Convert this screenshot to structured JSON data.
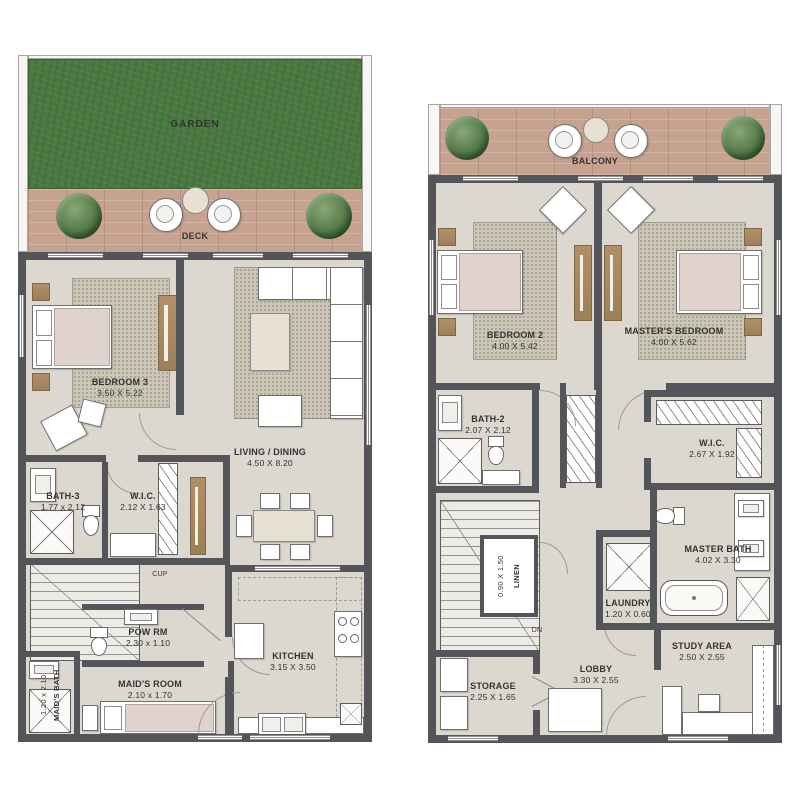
{
  "palette": {
    "wall": "#54555a",
    "floor": "#dcd8d0",
    "garden_green": "#4a7a41",
    "deck_wood": "#c7a290",
    "rug": "#ccc6b7",
    "wood_accent": "#ab8b61",
    "mattress": "#e0d2cd",
    "label_text": "#333333"
  },
  "left_plan": {
    "garden": {
      "label": "GARDEN"
    },
    "deck": {
      "label": "DECK"
    },
    "bedroom3": {
      "name": "BEDROOM 3",
      "dims": "3.50 X 5.22"
    },
    "living_dining": {
      "name": "LIVING / DINING",
      "dims": "4.50 X 8.20"
    },
    "bath3": {
      "name": "BATH-3",
      "dims": "1.77 x 2.12"
    },
    "wic": {
      "name": "W.I.C.",
      "dims": "2.12 X 1.63"
    },
    "cupboard": {
      "label": "CUP"
    },
    "pow_rm": {
      "name": "POW RM",
      "dims": "2.30 x 1.10"
    },
    "maids_room": {
      "name": "MAID'S ROOM",
      "dims": "2.10 x 1.70"
    },
    "maids_bath": {
      "name": "MAID'S BATH",
      "dims": "1.20 x 2.10"
    },
    "kitchen": {
      "name": "KITCHEN",
      "dims": "3.15 X 3.50"
    }
  },
  "right_plan": {
    "balcony": {
      "label": "BALCONY"
    },
    "bedroom2": {
      "name": "BEDROOM 2",
      "dims": "4.00 X 5.42"
    },
    "masters_bedroom": {
      "name": "MASTER'S BEDROOM",
      "dims": "4.00 X 5.62"
    },
    "bath2": {
      "name": "BATH-2",
      "dims": "2.07 X 2.12"
    },
    "wic": {
      "name": "W.I.C.",
      "dims": "2.67 X 1.92"
    },
    "linen": {
      "name": "LINEN",
      "dims": "0.90 X 1.50"
    },
    "laundry": {
      "name": "LAUNDRY",
      "dims": "1.20 X 0.60"
    },
    "master_bath": {
      "name": "MASTER BATH",
      "dims": "4.02 X 3.30"
    },
    "stairs_down": {
      "label": "DN"
    },
    "storage": {
      "name": "STORAGE",
      "dims": "2.25 X 1.65"
    },
    "lobby": {
      "name": "LOBBY",
      "dims": "3.30 X 2.55"
    },
    "study_area": {
      "name": "STUDY AREA",
      "dims": "2.50 X 2.55"
    }
  }
}
